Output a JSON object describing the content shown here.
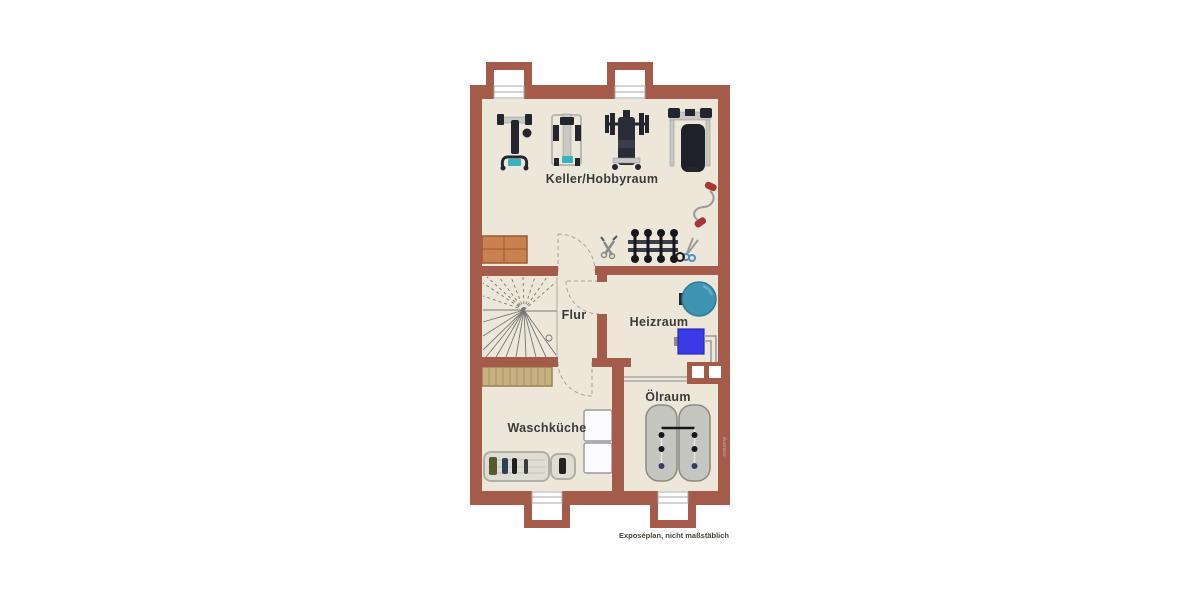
{
  "plan": {
    "type": "basement-floorplan",
    "rooms": [
      {
        "id": "keller",
        "label": "Keller/Hobbyraum"
      },
      {
        "id": "flur",
        "label": "Flur"
      },
      {
        "id": "heizraum",
        "label": "Heizraum"
      },
      {
        "id": "oelraum",
        "label": "Ölraum"
      },
      {
        "id": "waschkueche",
        "label": "Waschküche"
      }
    ],
    "caption": "Exposéplan, nicht maßstäblich",
    "watermark": "Illustration",
    "colors": {
      "background": "#FFFFFF",
      "wall": "#A55B49",
      "floor": "#EDE7D9",
      "window_well": "#FFFFFF",
      "boiler": "#3C93B2",
      "heater": "#3A3AE6",
      "oil_tank": "#C6C6C0",
      "wood_cabinet": "#C7B183",
      "sideboard": "#C9824F",
      "label_text": "#3B3B3B",
      "caption_text": "#4A443E"
    },
    "furniture_icons": [
      "hoist-machine-icon",
      "multi-gym-icon",
      "bench-press-icon",
      "weight-bench-icon",
      "jump-rope-icon",
      "dumbbell-rack-icon",
      "pliers-icon",
      "scissors-icon",
      "sideboard-icon",
      "winder-stairs-icon",
      "wooden-cabinet-icon",
      "washer-dryer-icon",
      "drying-rack-icon",
      "boiler-icon",
      "heating-unit-icon",
      "chimney-icon",
      "oil-tanks-icon",
      "oil-pipe-icon",
      "door-swing-icon",
      "window-icon"
    ]
  }
}
